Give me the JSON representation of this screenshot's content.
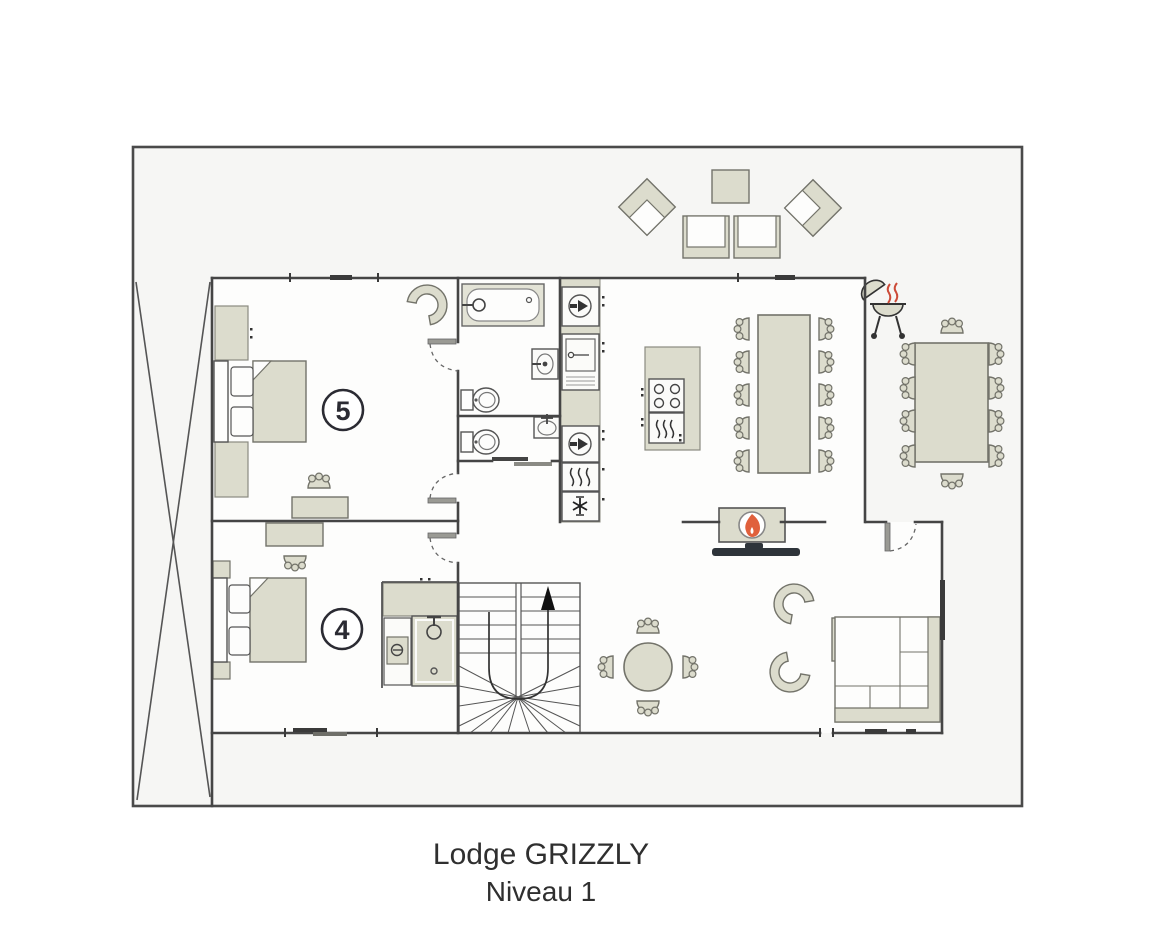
{
  "title": {
    "line1": "Lodge GRIZZLY",
    "line2": "Niveau 1"
  },
  "rooms": [
    {
      "id": "bedroom-5",
      "label": "5"
    },
    {
      "id": "bedroom-4",
      "label": "4"
    }
  ],
  "colors": {
    "wall": "#454545",
    "plan_background": "#f6f6f4",
    "interior_background": "#fdfdfc",
    "furniture_fill": "#dcdccd",
    "furniture_stroke": "#73736a",
    "appliance_fill": "#fbfbf9",
    "flame_orange": "#e0603c",
    "bbq_heat_red": "#cc4b38",
    "tv_dark": "#2e343a",
    "stairs_arrow": "#111111"
  },
  "icons": {
    "flame-icon": "flame",
    "snowflake-icon": "❄",
    "stairs-up-arrow-icon": "↑",
    "bbq-grill-icon": "kettle grill",
    "shower-head-icon": "shower head",
    "faucet-icon": "tap",
    "stove-burners-icon": "4 burners",
    "oven-heat-icon": "heat waves",
    "washing-machine-icon": "drum",
    "toilet-icon": "toilet",
    "bathtub-icon": "bathtub"
  }
}
